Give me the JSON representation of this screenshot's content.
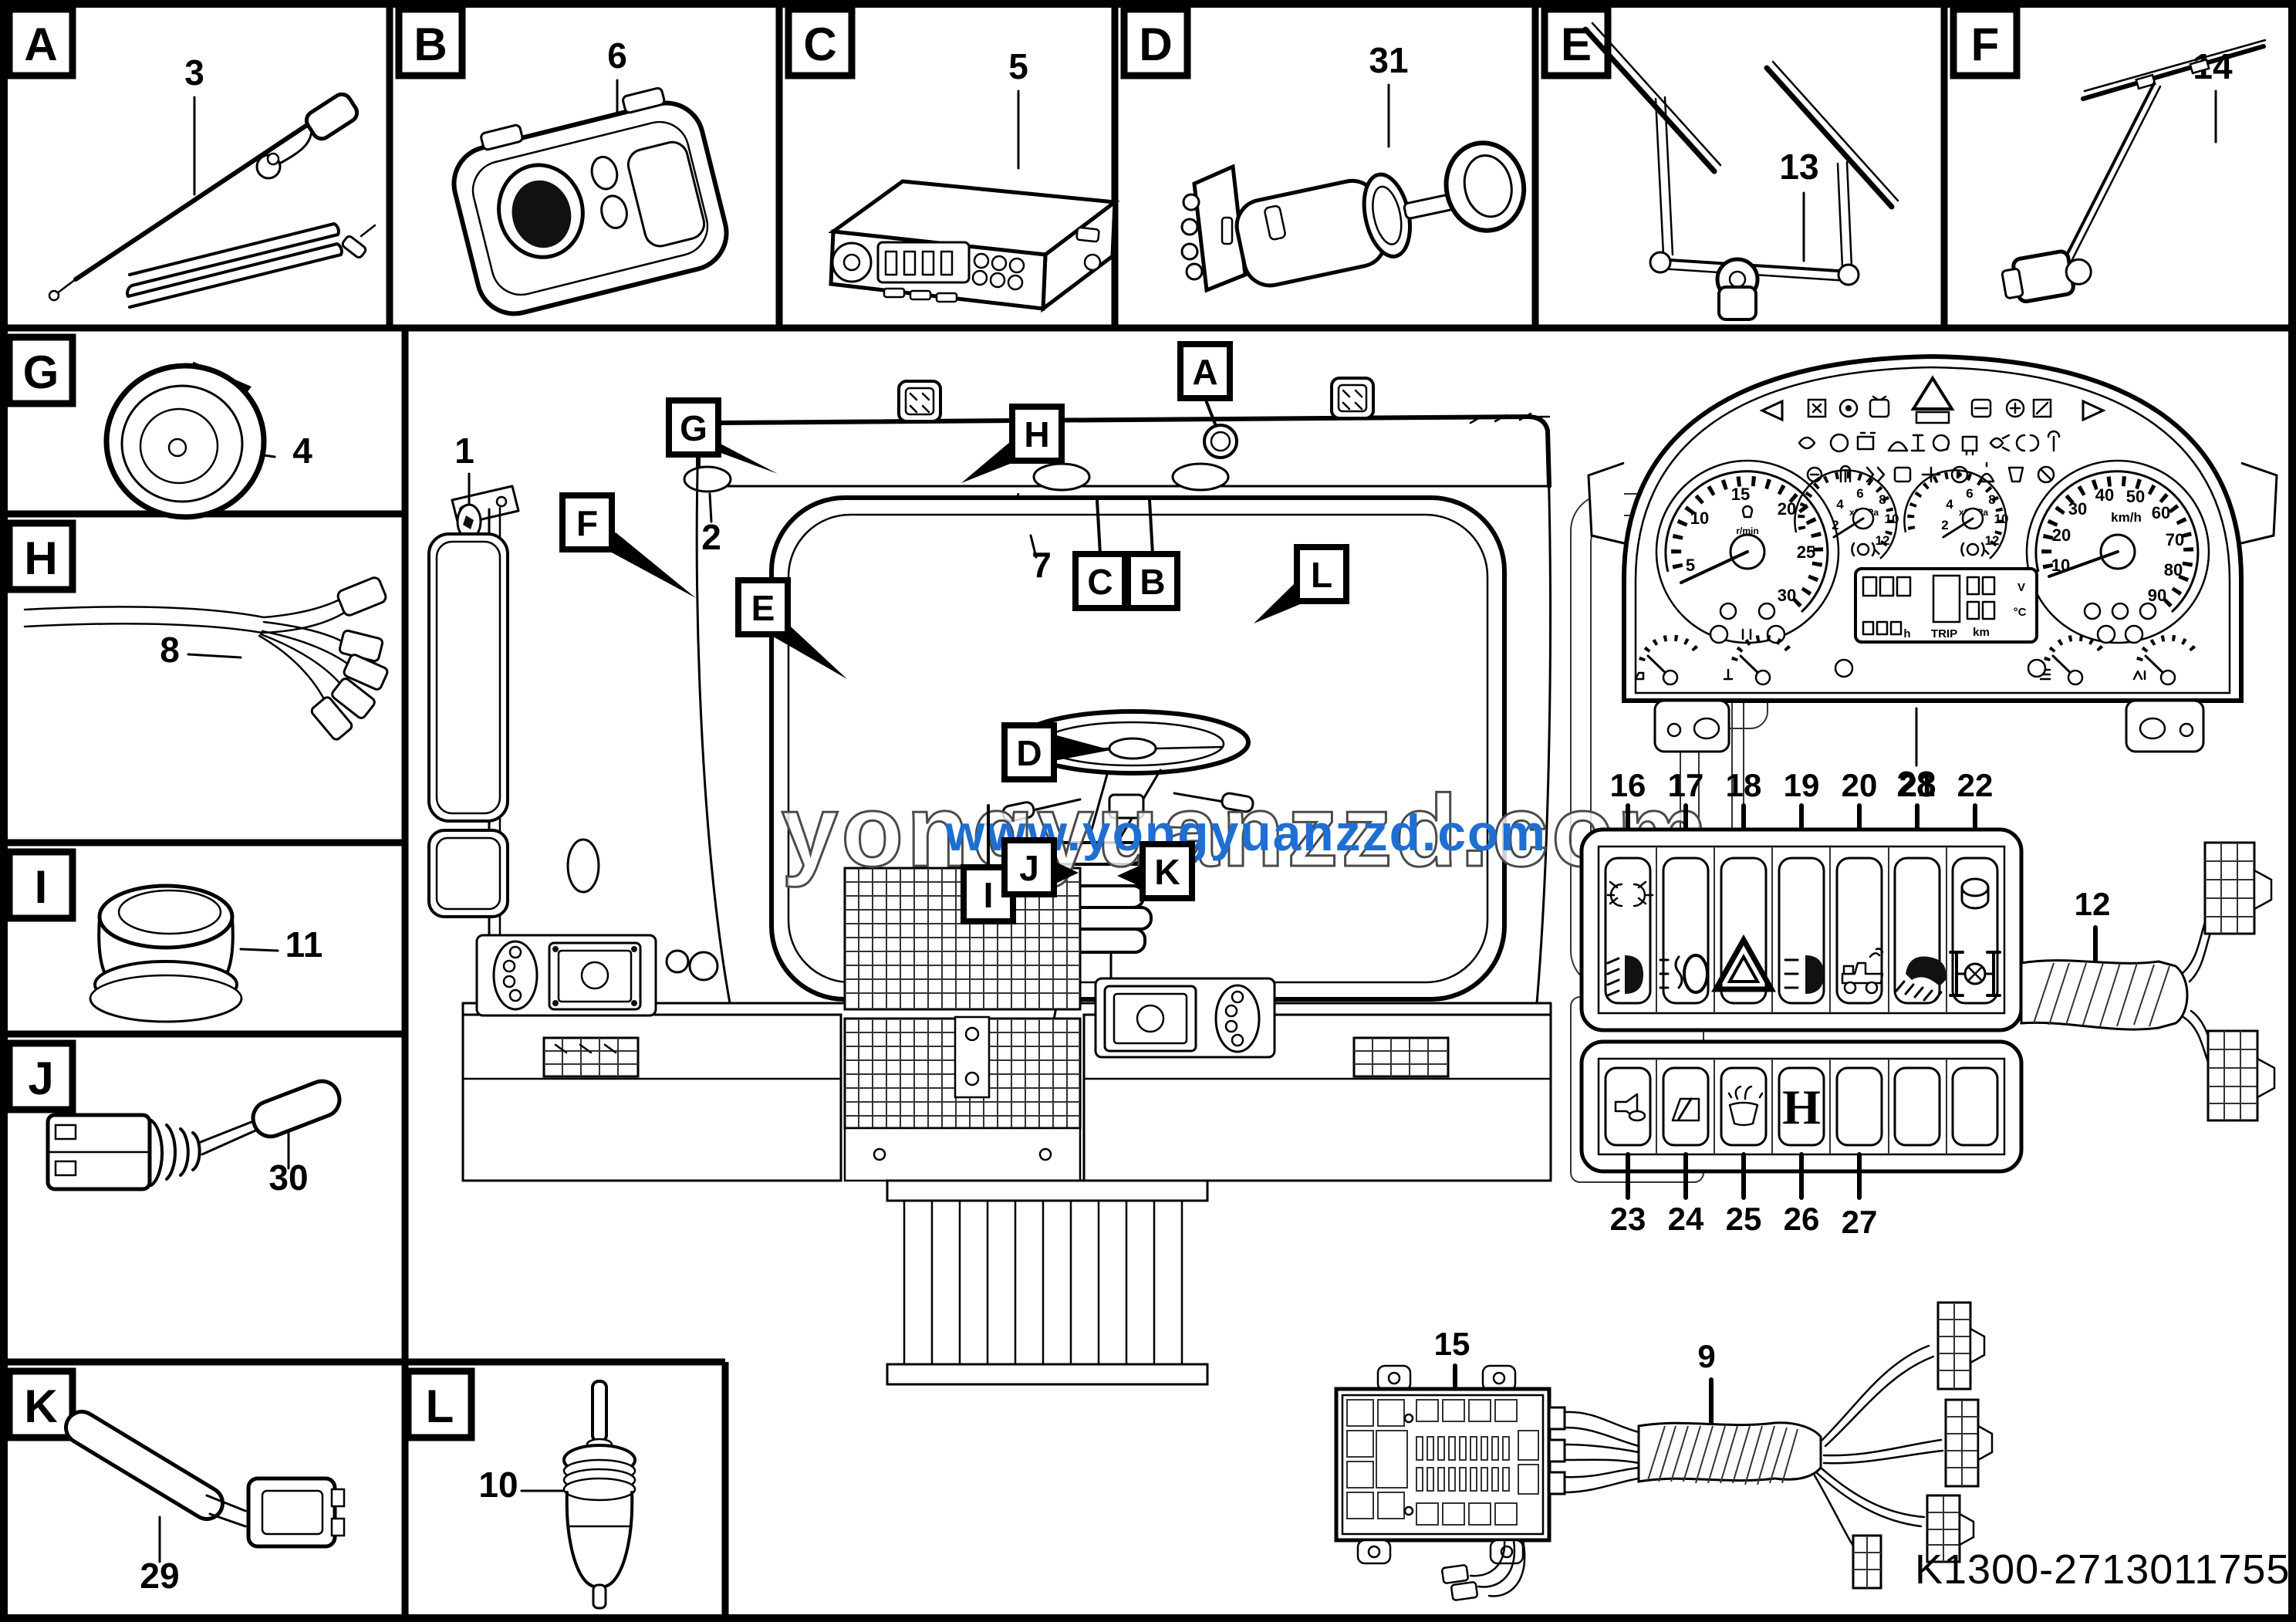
{
  "page": {
    "part_code": "K1300-2713011755"
  },
  "watermark": {
    "outline_text": "yongyuanzzd.com",
    "link_text": "www.yongyuanzzd.com",
    "link_color": "#1f6fd2"
  },
  "boxes": {
    "a": {
      "letter": "A",
      "part": "3"
    },
    "b": {
      "letter": "B",
      "part": "6"
    },
    "c": {
      "letter": "C",
      "part": "5"
    },
    "d": {
      "letter": "D",
      "part": "31"
    },
    "e": {
      "letter": "E",
      "part": "13"
    },
    "f": {
      "letter": "F",
      "part": "14"
    },
    "g": {
      "letter": "G",
      "part": "4"
    },
    "h": {
      "letter": "H",
      "part": "8"
    },
    "i": {
      "letter": "I",
      "part": "11"
    },
    "j": {
      "letter": "J",
      "part": "30"
    },
    "k": {
      "letter": "K",
      "part": "29"
    },
    "l": {
      "letter": "L",
      "part": "10"
    }
  },
  "callouts": {
    "a": "A",
    "b": "B",
    "c": "C",
    "d": "D",
    "e": "E",
    "f": "F",
    "g": "G",
    "h": "H",
    "i": "I",
    "j": "J",
    "k": "K",
    "l": "L",
    "n1": "1",
    "n2": "2",
    "n7": "7"
  },
  "cluster": {
    "label": "28",
    "tach": {
      "t0": "5",
      "t1": "10",
      "t2": "15",
      "t3": "20",
      "t4": "25",
      "t5": "30",
      "unit": "r/min"
    },
    "speed": {
      "t0": "10",
      "t1": "20",
      "t2": "30",
      "t3": "40",
      "t4": "50",
      "t5": "60",
      "t6": "70",
      "t7": "80",
      "t8": "90",
      "unit": "km/h"
    },
    "press": {
      "t0": "2",
      "t1": "4",
      "t2": "6",
      "t3": "8",
      "t4": "10",
      "t5": "12",
      "unit": "x1MPa"
    },
    "lcd": {
      "v": "V",
      "c": "°C",
      "km": "km",
      "h": "h",
      "trip": "TRIP"
    }
  },
  "switches": {
    "n16": "16",
    "n17": "17",
    "n18": "18",
    "n19": "19",
    "n20": "20",
    "n21": "21",
    "n22": "22",
    "n23": "23",
    "n24": "24",
    "n25": "25",
    "n26": "26",
    "n27": "27",
    "h_label": "H"
  },
  "labels": {
    "harness12": "12",
    "fusebox15": "15",
    "harness9": "9"
  }
}
